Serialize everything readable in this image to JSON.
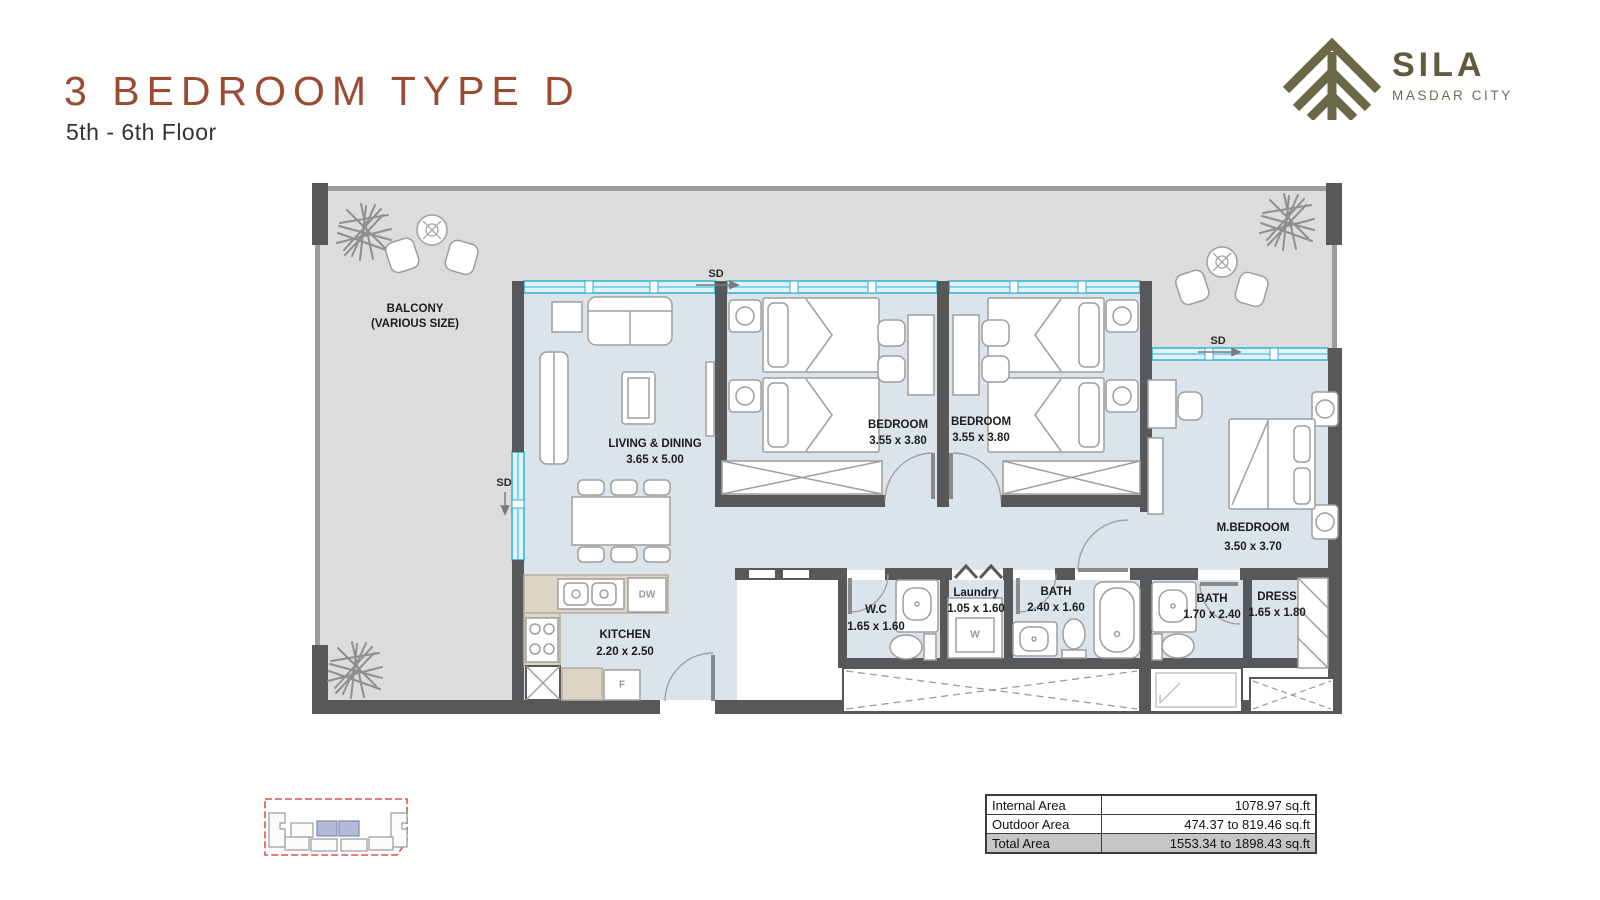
{
  "header": {
    "title": "3 BEDROOM TYPE D",
    "subtitle": "5th - 6th Floor"
  },
  "logo": {
    "name": "SILA",
    "city": "MASDAR CITY"
  },
  "plan": {
    "balcony": {
      "name": "BALCONY",
      "size": "(VARIOUS SIZE)"
    },
    "living": {
      "name": "LIVING & DINING",
      "size": "3.65 x 5.00"
    },
    "bedroom1": {
      "name": "BEDROOM",
      "size": "3.55 x 3.80"
    },
    "bedroom2": {
      "name": "BEDROOM",
      "size": "3.55 x 3.80"
    },
    "master": {
      "name": "M.BEDROOM",
      "size": "3.50 x 3.70"
    },
    "kitchen": {
      "name": "KITCHEN",
      "size": "2.20 x 2.50"
    },
    "wc": {
      "name": "W.C",
      "size": "1.65 x 1.60"
    },
    "laundry": {
      "name": "Laundry",
      "size": "1.05 x 1.60"
    },
    "bath": {
      "name": "BATH",
      "size": "2.40 x 1.60"
    },
    "master_bath": {
      "name": "BATH",
      "size": "1.70 x 2.40"
    },
    "dress": {
      "name": "DRESS",
      "size": "1.65 x 1.80"
    },
    "labels": {
      "sd": "SD",
      "dw": "DW",
      "fridge": "F",
      "washer": "W"
    }
  },
  "area_table": {
    "rows": [
      {
        "label": "Internal Area",
        "value": "1078.97 sq.ft"
      },
      {
        "label": "Outdoor Area",
        "value": "474.37 to 819.46 sq.ft"
      },
      {
        "label": "Total Area",
        "value": "1553.34 to 1898.43 sq.ft"
      }
    ]
  },
  "colors": {
    "accent": "#9a4c33",
    "logo": "#5f5c3c",
    "interior": "#dbe4ea",
    "balcony": "#dcdcdc",
    "wall": "#57585a",
    "window": "#2fb0d4"
  }
}
